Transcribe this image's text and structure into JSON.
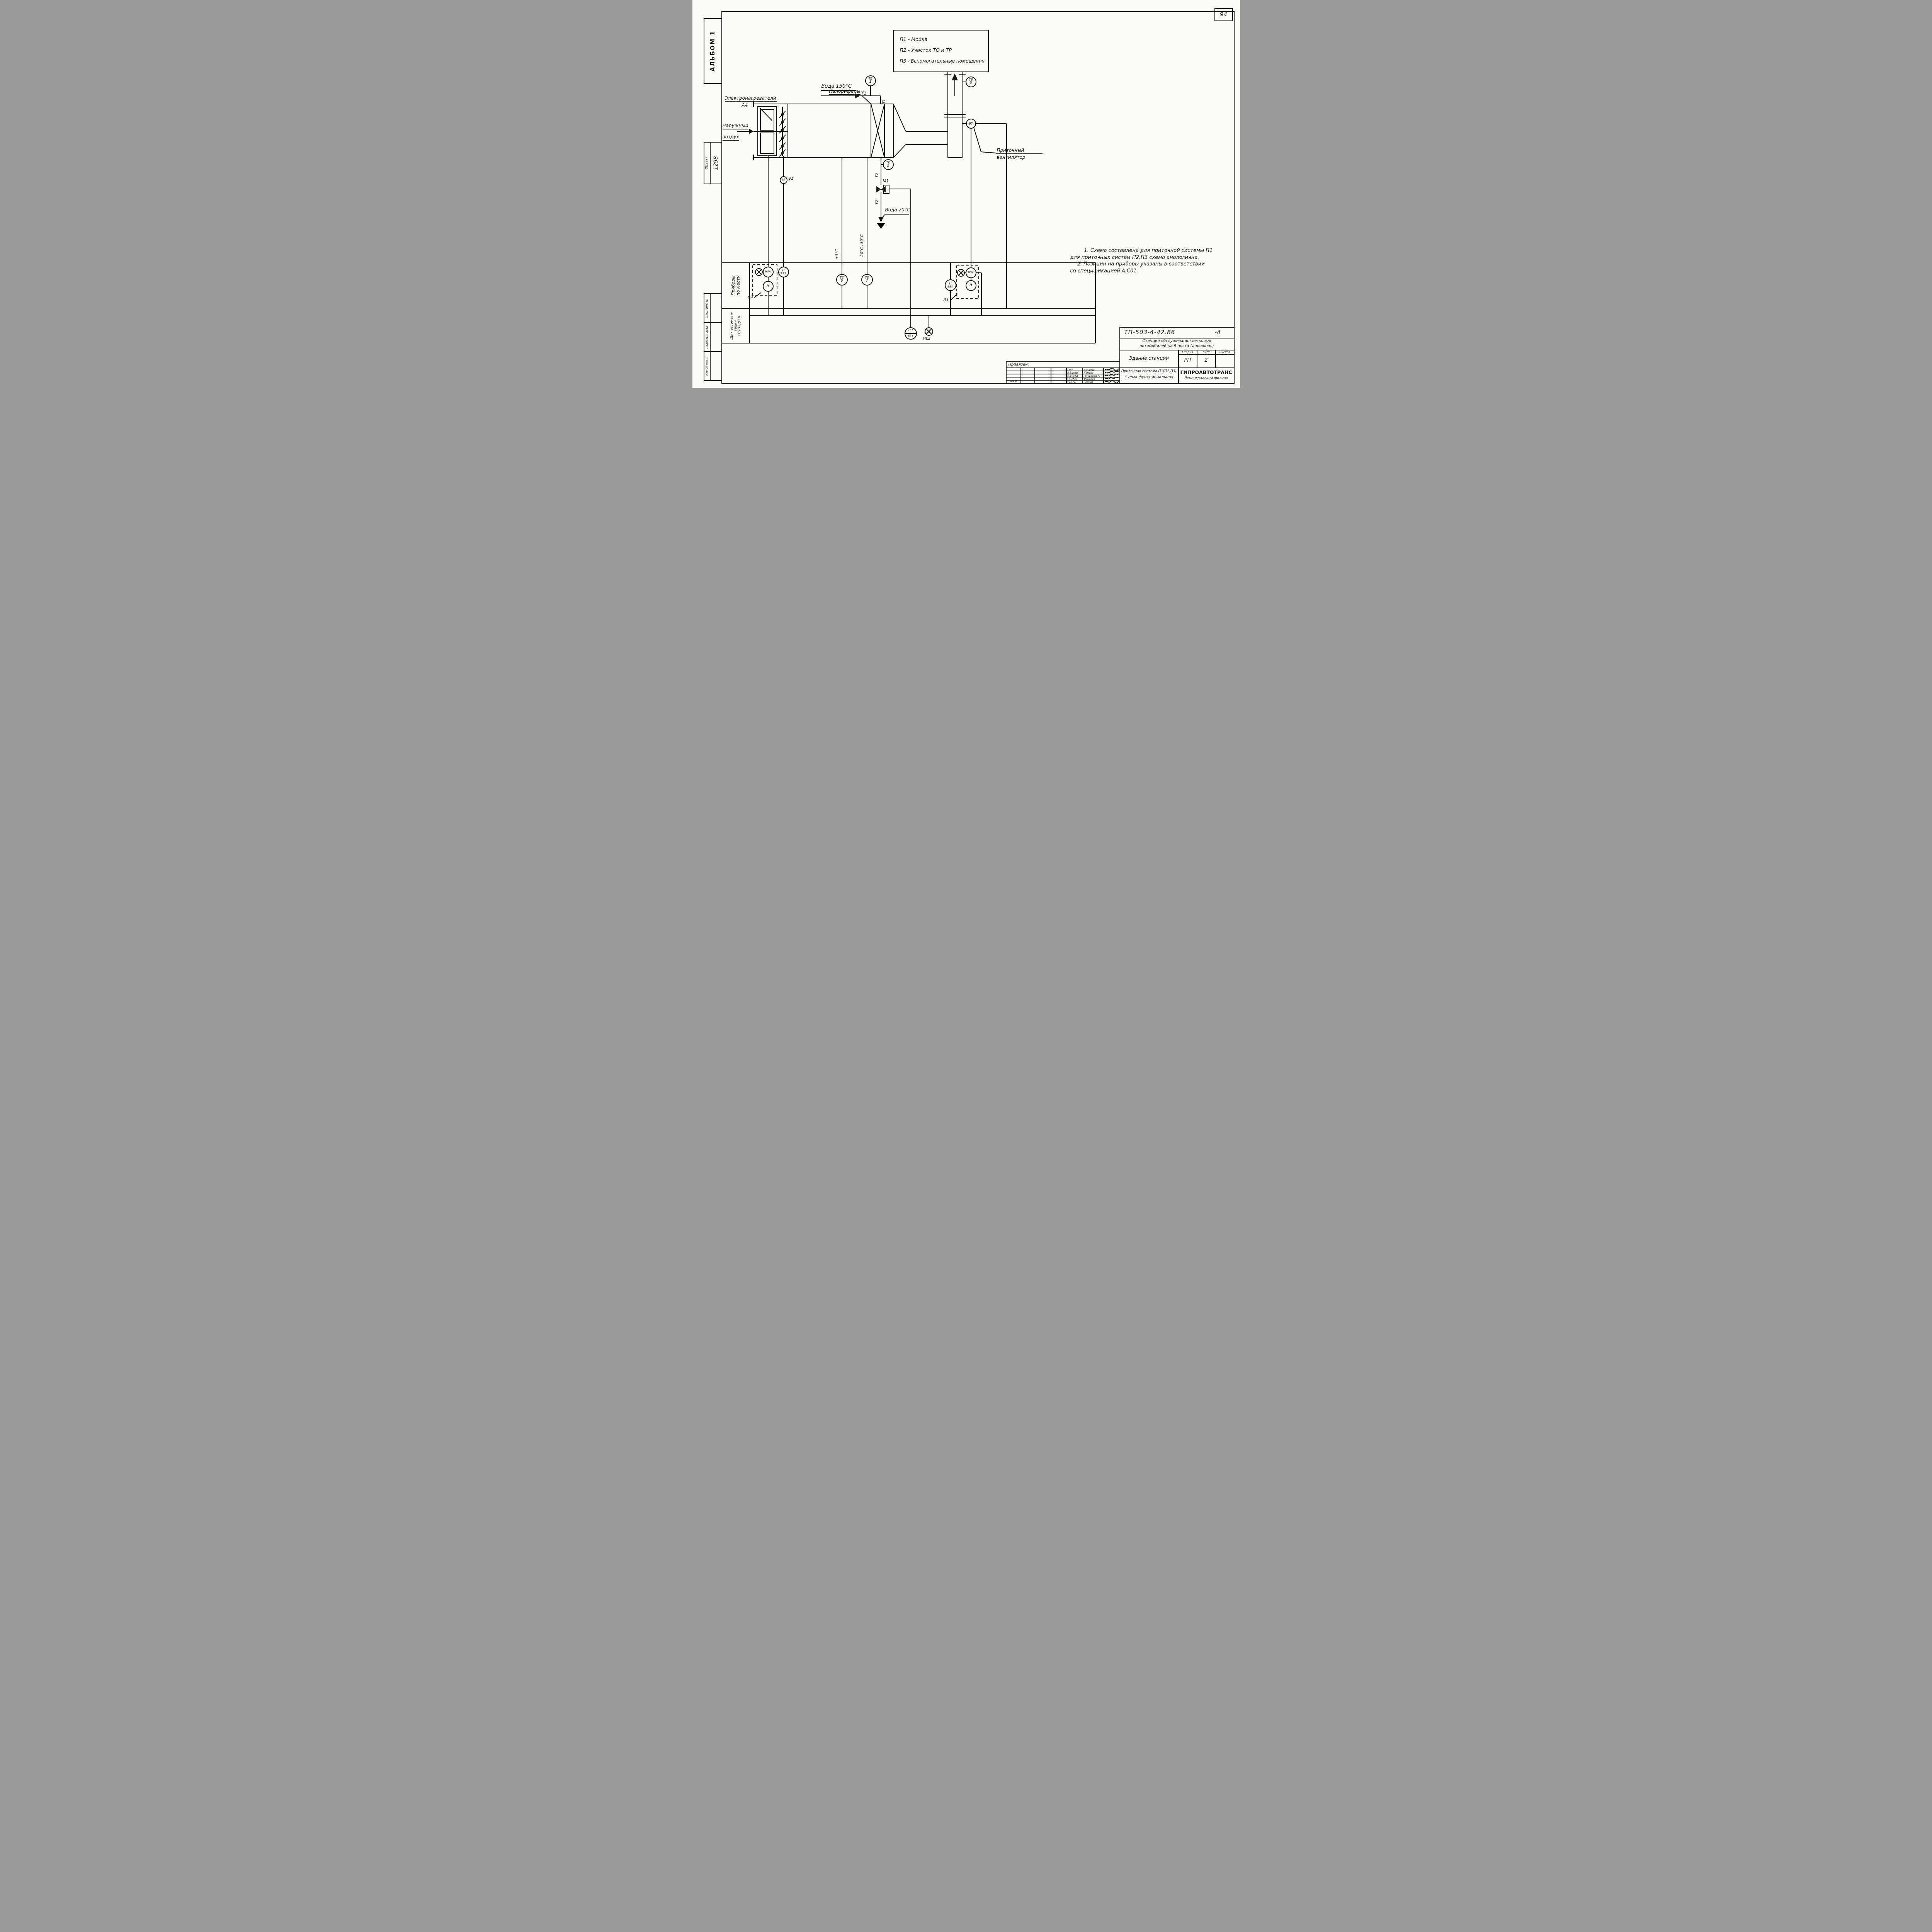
{
  "page": {
    "sheet_number": "94"
  },
  "sidebar": {
    "album": "АЛЬБОМ 1",
    "object_label": "Объект",
    "object_number": "1298",
    "cells": [
      "Взам. инв. №",
      "Подпись и дата",
      "Инв. № подл."
    ]
  },
  "legend": {
    "lines": [
      "П1  -  Мойка",
      "П2 -  Участок ТО и ТР",
      "П3 -  Вспомогательные помещения"
    ]
  },
  "labels": {
    "electric_heaters": "Электронагреватели",
    "electric_heaters_tag": "А4",
    "outdoor_air_line1": "Наружный",
    "outdoor_air_line2": "воздух",
    "calorifiers": "Калориферы",
    "water_supply": "Вода 150°С",
    "water_return": "Вода 70°С",
    "t1": "Т1",
    "t1_vert": "Т1",
    "t2_upper": "Т2",
    "t2_lower": "Т2",
    "valve_tag": "М1",
    "damper_actuator_tag": "УА",
    "fan_line1": "Приточный",
    "fan_line2": "вентилятор",
    "temp_tolerance": "±3°С",
    "temp_range": "20°С÷30°С",
    "panel_row1_line1": "Приборы",
    "panel_row1_line2": "по месту",
    "panel_row2_line1": "Щит автомати-",
    "panel_row2_line2": "зации",
    "panel_row2_line3": "П1(П2)(П3)",
    "box_a3": "А3",
    "box_a1": "А1",
    "lamp2_tag": "НL2"
  },
  "instruments": {
    "te1": {
      "top": "ТЕ",
      "bottom": "1"
    },
    "te2": {
      "top": "ТЕ",
      "bottom": "2"
    },
    "te5": {
      "top": "ТЕ",
      "bottom": "5"
    },
    "te6": {
      "top": "ТЕ",
      "bottom": "6"
    },
    "te7": {
      "top": "ТЕ",
      "bottom": "7"
    },
    "fan_motor": "М",
    "damper_motor": "М",
    "hsa_left": "НSА",
    "h_left": "Н",
    "h_sb2": {
      "top": "Н",
      "bottom": "SБ2"
    },
    "h_sb1": {
      "top": "Н",
      "bottom": "SБ1"
    },
    "hsa_right": "НSА",
    "h_right": "Н",
    "hz_sa1": {
      "top": "НЗ",
      "bottom": "SА1"
    }
  },
  "notes": {
    "line1": "1. Схема составлена для приточной системы П1",
    "line2": "для приточных систем П2,П3 схема аналогична.",
    "line3": "2. Позиции на приборы указаны в соответствии",
    "line4": "со спецификацией А.С01."
  },
  "title_block": {
    "doc_number": "ТП-503-4-42.86",
    "doc_suffix": "-А",
    "project_line1": "Станция обслуживания легковых",
    "project_line2": "автомобилей на 9 поста (дорожная)",
    "object_name": "Здание станции",
    "stage_label": "Стадия",
    "sheet_label": "Лист",
    "sheets_label": "Листов",
    "stage": "РП",
    "sheet": "2",
    "sheets": "",
    "drawing_line1": "Приточная система П1(П2,П3)",
    "drawing_line2": "Схема функциональная",
    "org": "ГИПРОАВТОТРАНС",
    "org_branch": "Ленинградский филиал",
    "attached": "Привязан:",
    "inv_label": "Инв.№",
    "signers": [
      {
        "role": "ГИП",
        "name": "Чекалов"
      },
      {
        "role": "Н.контр",
        "name": "Комова"
      },
      {
        "role": "Нач.отд",
        "name": "Грищенович"
      },
      {
        "role": "Гл.спец",
        "name": "Фонарев"
      },
      {
        "role": "Рук.гр.",
        "name": "Комова"
      }
    ]
  }
}
